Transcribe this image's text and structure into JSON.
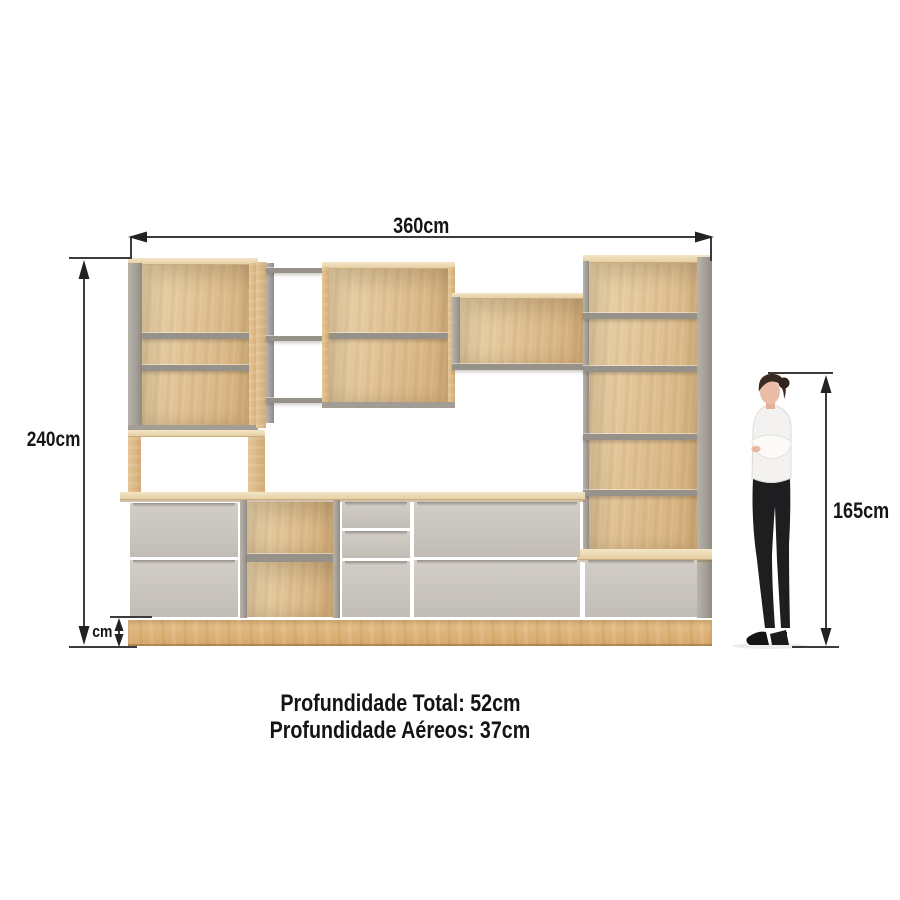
{
  "annotations": {
    "width_total": "360cm",
    "height_total": "240cm",
    "person_height": "165cm",
    "plinth_height": "cm"
  },
  "footer": {
    "depth_total": "Profundidade Total: 52cm",
    "depth_wall": "Profundidade Aéreos: 37cm"
  },
  "colors": {
    "background": "#ffffff",
    "wood_face": "#e1c396",
    "wood_edge": "#ecd9b3",
    "wood_plinth": "#d9ab70",
    "gray_panel": "#a7a39b",
    "gray_shelf": "#96928a",
    "door_front": "#c9c5be",
    "dimension_line": "#3c3c3c",
    "label_text": "#161616",
    "person_shirt": "#f3f2f0",
    "person_pants": "#1e1d20",
    "person_skin": "#ecbda6",
    "person_hair": "#3a2a21"
  }
}
